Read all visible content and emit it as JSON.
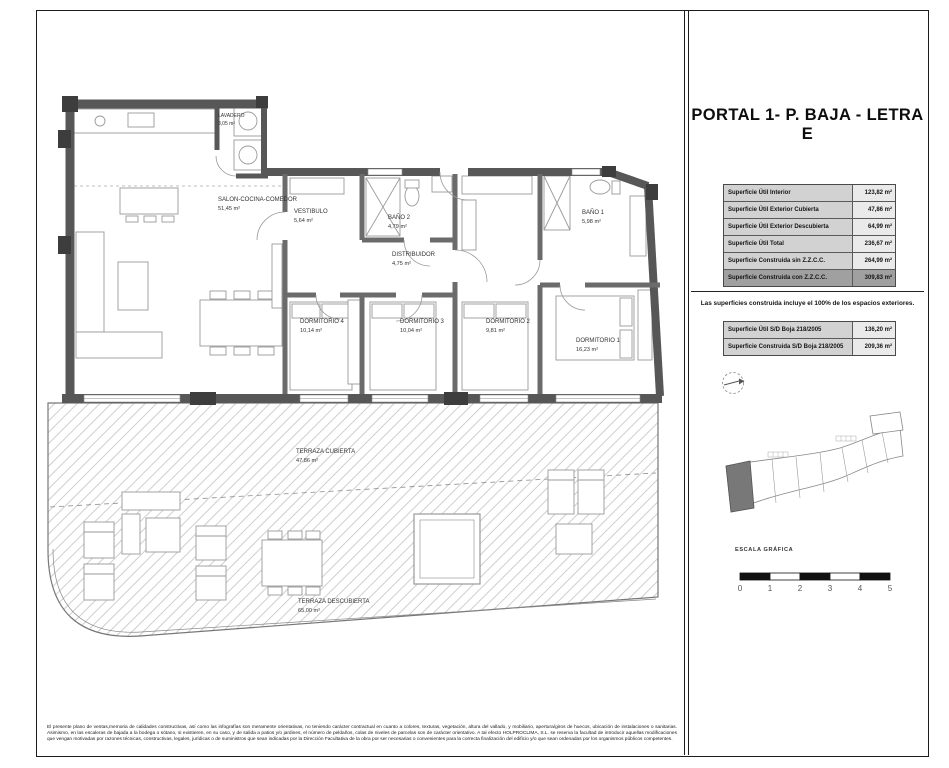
{
  "colors": {
    "wall": "#575757",
    "hatch": "#c9c9c9",
    "table_header_bg": "#d2d2d2",
    "table_value_bg": "#eaeaea",
    "table_highlight_bg": "#a0a0a0",
    "keyplan_highlight": "#787878"
  },
  "sheet": {
    "title": "PORTAL 1- P. BAJA - LETRA E",
    "surface_table": {
      "rows": [
        {
          "label": "Superficie Útil Interior",
          "value": "123,82 m²"
        },
        {
          "label": "Superficie Útil Exterior Cubierta",
          "value": "47,86 m²"
        },
        {
          "label": "Superficie Útil Exterior Descubierta",
          "value": "64,99 m²"
        },
        {
          "label": "Superficie Útil Total",
          "value": "236,67 m²"
        },
        {
          "label": "Superficie Construida sin Z.Z.C.C.",
          "value": "264,99 m²"
        },
        {
          "label": "Superficie Construida con Z.Z.C.C.",
          "value": "309,83 m²"
        }
      ]
    },
    "note": "Las superficies construida incluye el 100% de los espacios exteriores.",
    "boja_table": {
      "rows": [
        {
          "label": "Superficie Útil S/D Boja 218/2005",
          "value": "136,20 m²"
        },
        {
          "label": "Superficie Construida S/D Boja 218/2005",
          "value": "209,36 m²"
        }
      ]
    },
    "scale": {
      "label": "ESCALA GRÁFICA",
      "ticks": [
        "0",
        "1",
        "2",
        "3",
        "4",
        "5"
      ]
    },
    "disclaimer": "El presente plano de ventas,memoria de calidades constructivas, así como las infografías son meramente orientativas, no teniendo carácter contractual en cuanto a colores, texturas, vegetación, altura del vallado, y mobiliario, apertura/giros de huecos, ubicación de instalaciones o sanitarias. Asimismo, en las escaleras de bajada a la bodega o sótano, si existieren, en su caso, y de salida a patios y/o jardines, el número de peldaños, colas de niveles de parcelas son de carácter orientativo. A tal efecto HOLPROCLIMA, S.L. se reserva la facultad de introducir aquellas modificaciones que vengan motivadas por razones técnicas, constructivas, legales, jurídicas o de suministros que sean indicadas por la Dirección Facultativa de la obra por ser necesarias o convenientes para la correcta finalización del edificio y/o que sean ordenadas por los organismos públicos competentes."
  },
  "floor_plan": {
    "rooms": [
      {
        "name": "LAVADERO",
        "area": "3,05 m²"
      },
      {
        "name": "SALON-COCINA-COMEDOR",
        "area": "51,45 m²"
      },
      {
        "name": "VESTIBULO",
        "area": "5,64 m²"
      },
      {
        "name": "BAÑO 2",
        "area": "4,79 m²"
      },
      {
        "name": "DISTRIBUIDOR",
        "area": "4,75 m²"
      },
      {
        "name": "BAÑO 1",
        "area": "5,98 m²"
      },
      {
        "name": "DORMITORIO 4",
        "area": "10,14 m²"
      },
      {
        "name": "DORMITORIO 3",
        "area": "10,04 m²"
      },
      {
        "name": "DORMITORIO 2",
        "area": "9,81 m²"
      },
      {
        "name": "DORMITORIO 1",
        "area": "16,23 m²"
      },
      {
        "name": "TERRAZA CUBIERTA",
        "area": "47,86 m²"
      },
      {
        "name": "TERRAZA DESCUBIERTA",
        "area": "65,00 m²"
      }
    ]
  }
}
